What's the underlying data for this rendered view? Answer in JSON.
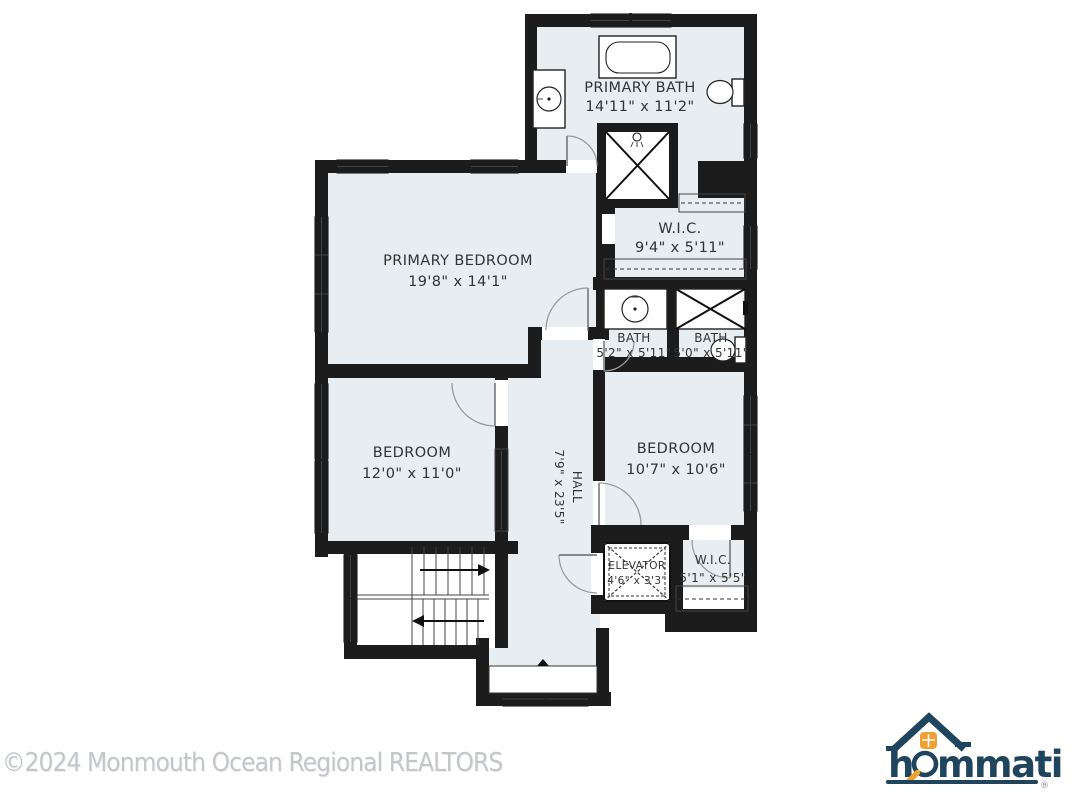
{
  "rooms": [
    {
      "id": "primary-bath",
      "name": "PRIMARY BATH",
      "dims": "14'11\" x 11'2\""
    },
    {
      "id": "wic-upper",
      "name": "W.I.C.",
      "dims": "9'4\" x 5'11\""
    },
    {
      "id": "primary-bedroom",
      "name": "PRIMARY BEDROOM",
      "dims": "19'8\" x 14'1\""
    },
    {
      "id": "bath-left",
      "name": "BATH",
      "dims": "5'2\" x 5'11\""
    },
    {
      "id": "bath-right",
      "name": "BATH",
      "dims": "5'0\" x 5'11\""
    },
    {
      "id": "bedroom-left",
      "name": "BEDROOM",
      "dims": "12'0\" x 11'0\""
    },
    {
      "id": "hall",
      "name": "HALL",
      "dims": "7'9\" x 23'5\""
    },
    {
      "id": "bedroom-right",
      "name": "BEDROOM",
      "dims": "10'7\" x 10'6\""
    },
    {
      "id": "elevator",
      "name": "ELEVATOR",
      "dims": "4'6\" x 3'3\""
    },
    {
      "id": "wic-lower",
      "name": "W.I.C.",
      "dims": "5'1\" x 5'5\""
    }
  ],
  "watermark": "©2024 Monmouth Ocean Regional REALTORS",
  "logo": {
    "brand": "hommati",
    "registered": "®"
  },
  "colors": {
    "wall": "#1c1c1c",
    "room_fill": "#e7edf1",
    "logo_navy": "#1f455e",
    "logo_orange": "#f0a132"
  }
}
